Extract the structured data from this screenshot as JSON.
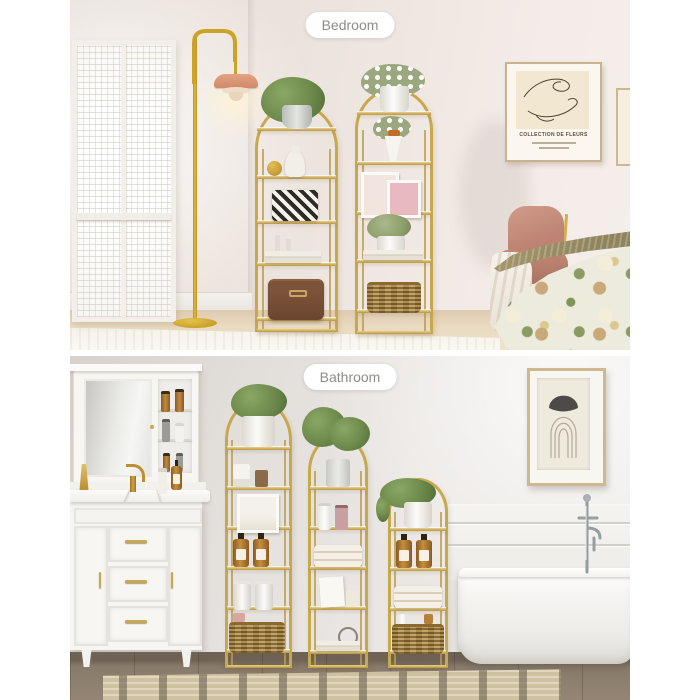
{
  "badges": {
    "bedroom": "Bedroom",
    "bathroom": "Bathroom"
  },
  "poster": {
    "title": "COLLECTION DE FLEURS"
  },
  "palette": {
    "gold": "#c7a84f",
    "gold_bright": "#e9d28e",
    "lamp_yellow": "#d9ab26",
    "shade_salmon": "#df9f80",
    "chair_pink": "#c48b79",
    "bedroom_wall": "#ece3dd",
    "bathroom_wall": "#e7e3df",
    "bed_floor_wood": "#e7d7bf",
    "bath_floor_wood": "#8d8072",
    "rug_beige": "#cfc2a3",
    "basket_wicker": "#a5823f",
    "amber_bottle": "#b5803a",
    "pill_text": "#8f8d8a",
    "pill_background": "#ffffff"
  }
}
